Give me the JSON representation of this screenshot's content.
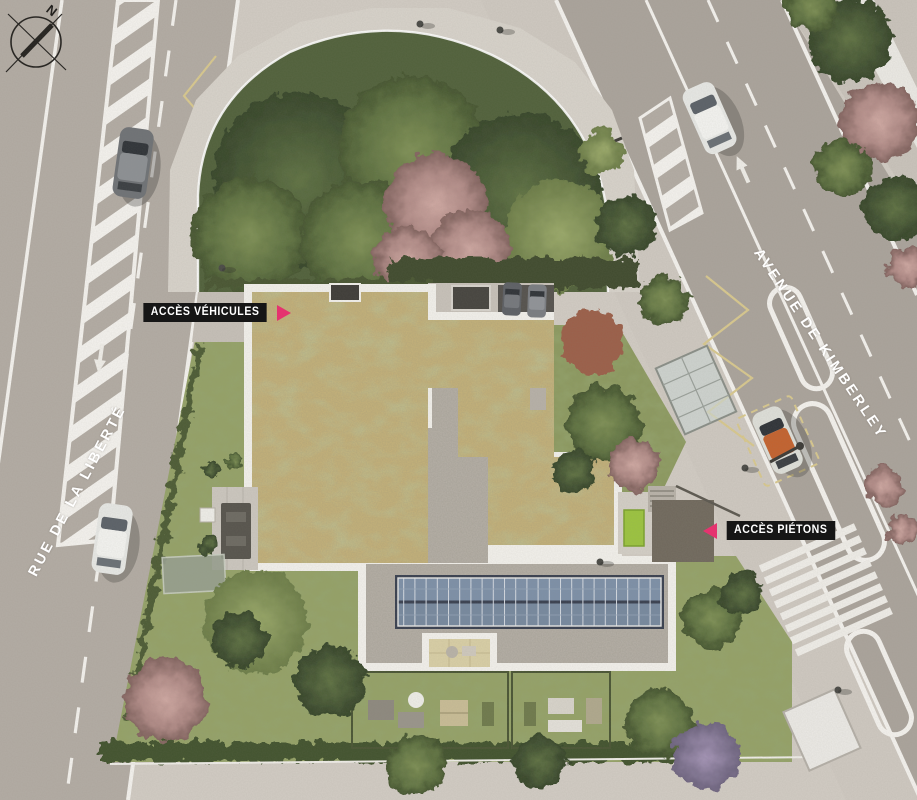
{
  "compass": {
    "north": "N"
  },
  "streets": {
    "left": "RUE DE LA LIBERTÉ",
    "right": "AVENUE DE KIMBERLEY"
  },
  "access": {
    "vehicles": "ACCÈS VÉHICULES",
    "pedestrians": "ACCÈS PIÉTONS"
  },
  "colors": {
    "accent_pink": "#e5336f",
    "label_bg": "#161616",
    "label_text": "#ffffff",
    "road": "#b3aca4",
    "sidewalk": "#d2ccc4",
    "lawn": "#95a267",
    "park_green": "#51613b",
    "green_roof_sedum": "#c6b379",
    "gravel_roof": "#b7b1a8",
    "solar_panel": "#7d90a8",
    "marking_yellow": "#d9c98f",
    "parapet_white": "#f3f1ec"
  }
}
